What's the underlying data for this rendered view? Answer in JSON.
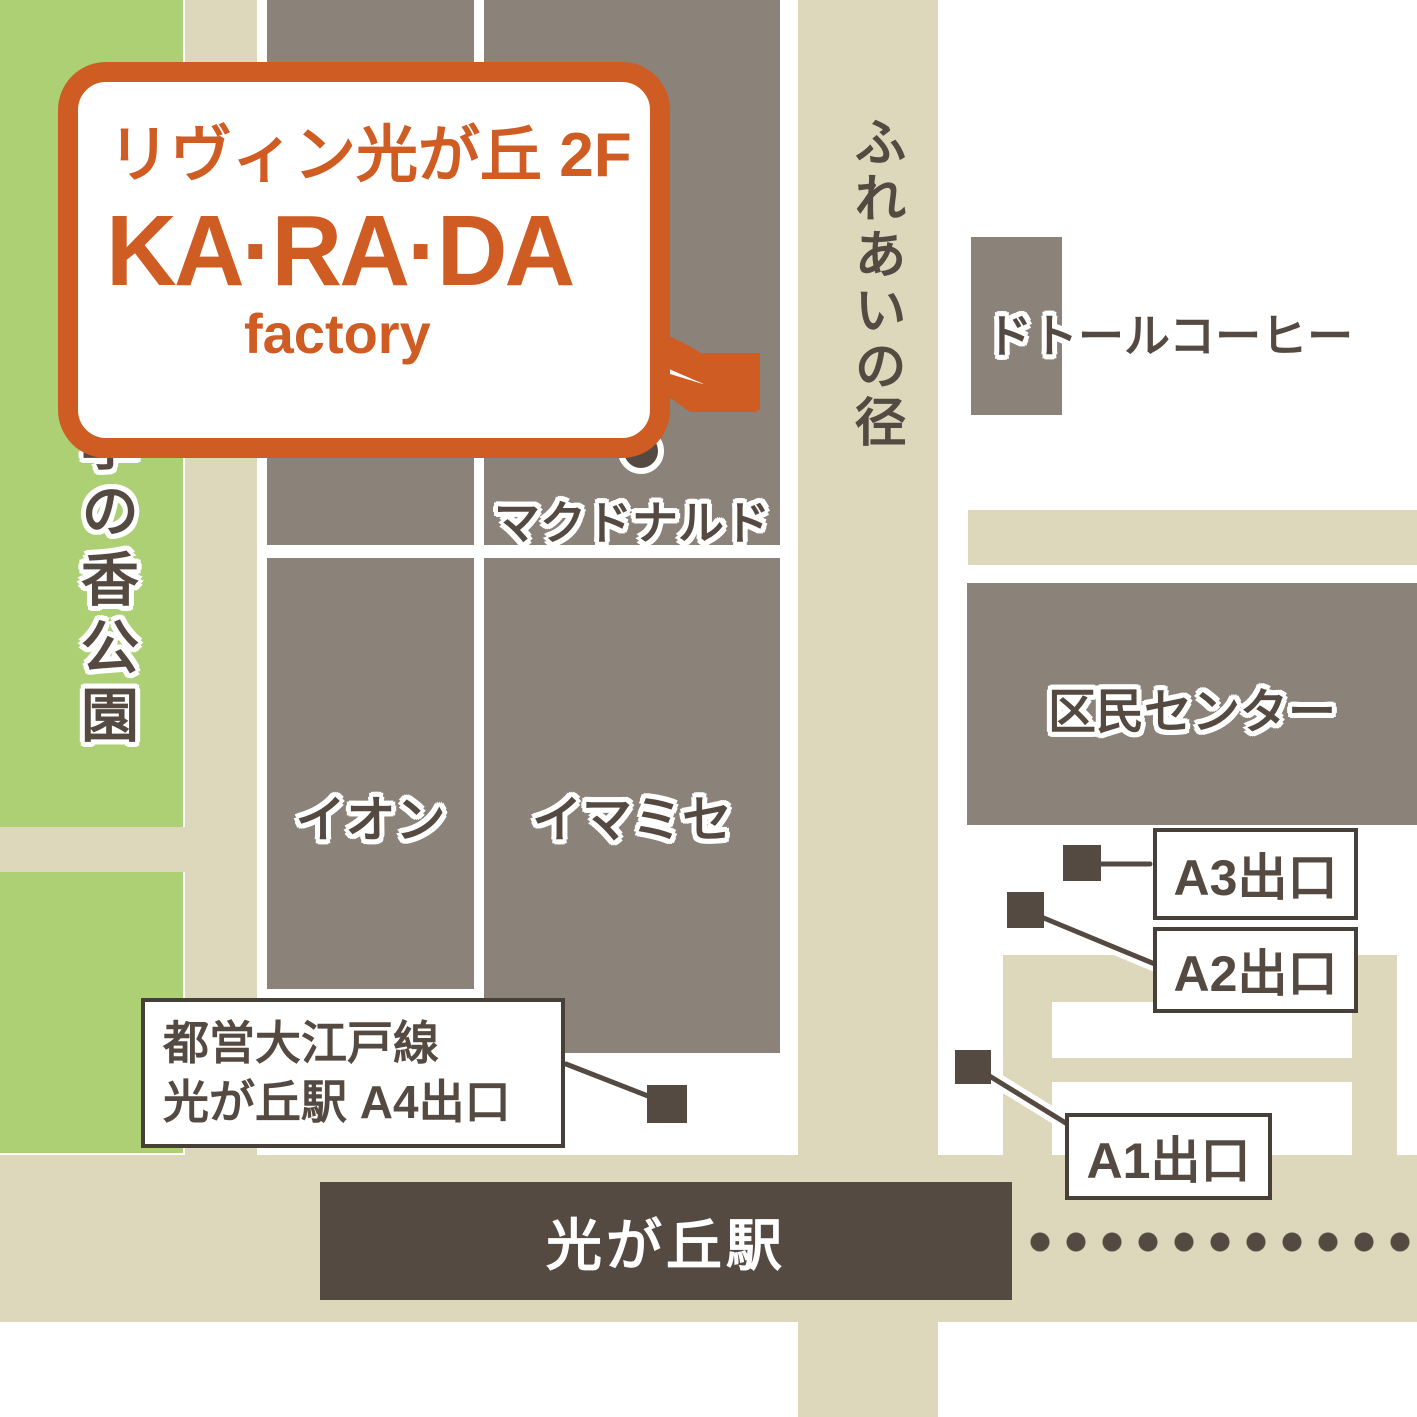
{
  "bubble": {
    "line1": "リヴィン光が丘 2F",
    "brand": "KA·RA·DA",
    "brand_sub": "factory"
  },
  "places": {
    "park": "四季の香公園",
    "fureai_road": "ふれあいの径",
    "mcdonalds": "マクドナルド",
    "aeon": "イオン",
    "imamise": "イマミセ",
    "doutor": "ドトールコーヒー",
    "kumin_center": "区民センター",
    "station": "光が丘駅"
  },
  "exits": {
    "a1": "A1出口",
    "a2": "A2出口",
    "a3": "A3出口",
    "a4_line1": "都営大江戸線",
    "a4_line2": "光が丘駅 A4出口"
  },
  "colors": {
    "park_green": "#aed075",
    "road_beige": "#ddd8bb",
    "building_gray": "#8b8279",
    "dark_brown": "#554a42",
    "brand_orange": "#cf5c22",
    "white": "#ffffff"
  }
}
